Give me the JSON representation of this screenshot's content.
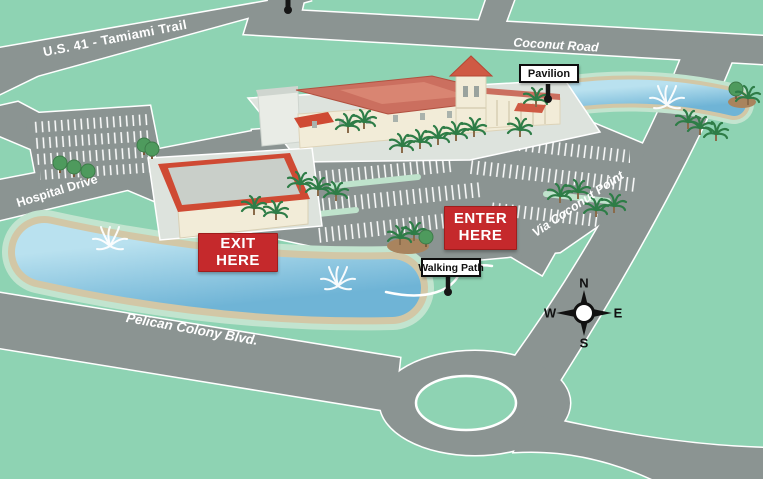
{
  "map": {
    "roads": {
      "us41": "U.S. 41 - Tamiami Trail",
      "coconut_road": "Coconut Road",
      "hospital_drive": "Hospital Drive",
      "via_coconut_point": "Via Coconut Point",
      "pelican_colony_blvd": "Pelican Colony Blvd."
    },
    "signs": {
      "exit": {
        "line1": "EXIT",
        "line2": "HERE"
      },
      "enter": {
        "line1": "ENTER",
        "line2": "HERE"
      }
    },
    "callouts": {
      "pavilion": "Pavilion",
      "walking_path": "Walking Path"
    },
    "compass": {
      "north": "N",
      "south": "S",
      "east": "E",
      "west": "W"
    },
    "colors": {
      "background": "#8ed3b3",
      "road_gray": "#8b9492",
      "road_edge": "#ffffff",
      "lake_blue": "#72b6d6",
      "lake_shore_tan": "#d2c7a6",
      "shore_green": "#c2e4cf",
      "roof_red": "#cb6f5f",
      "roof_accent_red": "#cf4a33",
      "building_cream": "#f2ecd8",
      "sign_red": "#c5292c",
      "sign_text": "#ffffff",
      "callout_bg": "#ffffff",
      "callout_border": "#111111"
    }
  }
}
